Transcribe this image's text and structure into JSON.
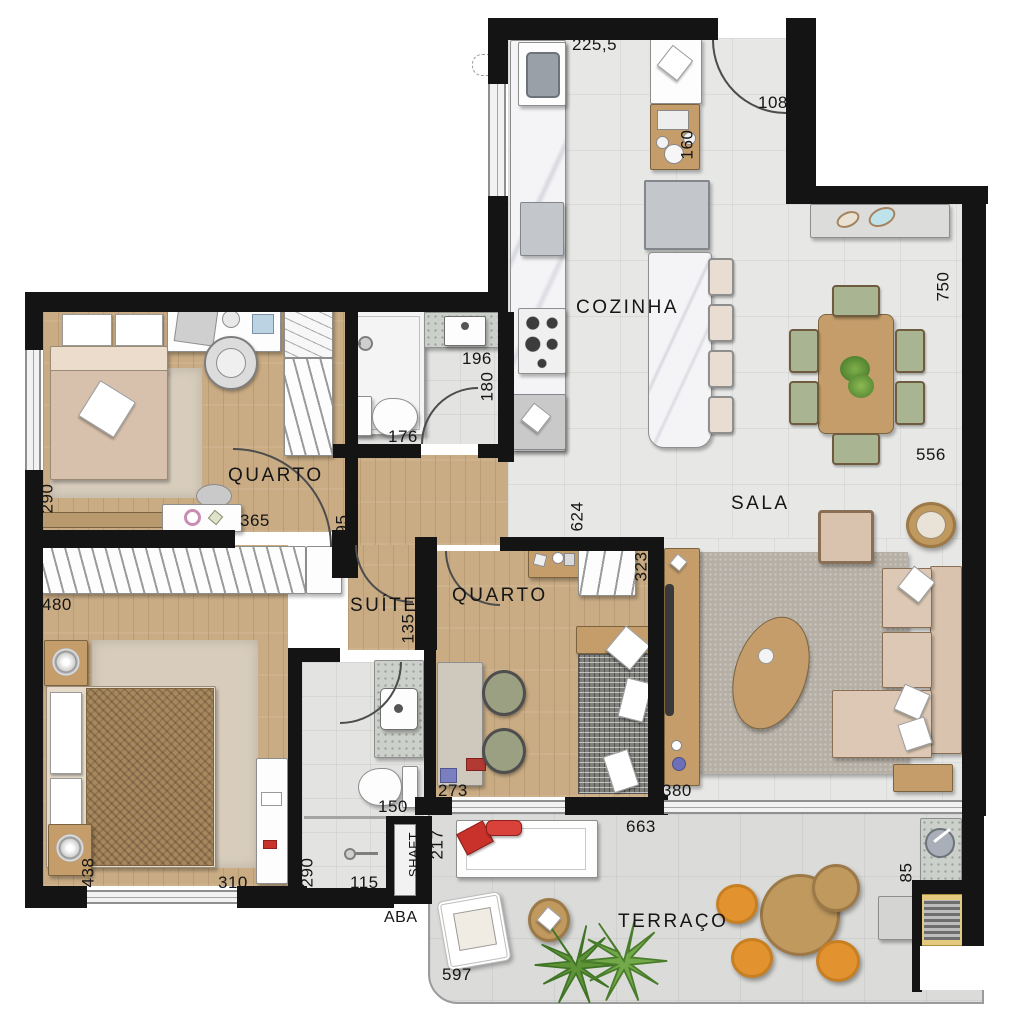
{
  "rooms": {
    "cozinha": "COZINHA",
    "sala": "SALA",
    "quarto1": "QUARTO",
    "quarto2": "QUARTO",
    "suite": "SUÍTE",
    "terraco": "TERRAÇO",
    "shaft": "SHAFT",
    "aba": "ABA"
  },
  "dims": {
    "kitchen_top": "225,5",
    "entry": "108",
    "pantry_cabinet": "160",
    "bath_sink": "196",
    "bath_depth": "180",
    "bath_toilet": "176",
    "sala_right_height": "750",
    "sala_width": "556",
    "quarto1_left": "290",
    "quarto1_bottom": "365",
    "hall_post": "95",
    "suite_wardrobe": "480",
    "corridor": "135",
    "sala_left_height": "624",
    "quarto2_right": "323",
    "suite_left": "438",
    "suite_bottom": "310",
    "ensuite_shower": "290",
    "ensuite_bottom": "115",
    "ensuite_toilet": "150",
    "quarto2_desk": "273",
    "quarto2_bed": "380",
    "terrace_top": "663",
    "terrace_lounger": "217",
    "terrace_chair": "597",
    "bbq_counter": "85"
  },
  "colors": {
    "wall": "#141414",
    "wood_floor": "#c9ac84",
    "tile_floor": "#e7e8e6",
    "wood_furniture": "#c59d6b",
    "sofa_beige": "#d9c3ae",
    "chair_green": "#a9b493",
    "pouf_orange": "#e2932f",
    "pillow_red": "#c8322b",
    "plant_green": "#5e9437"
  }
}
